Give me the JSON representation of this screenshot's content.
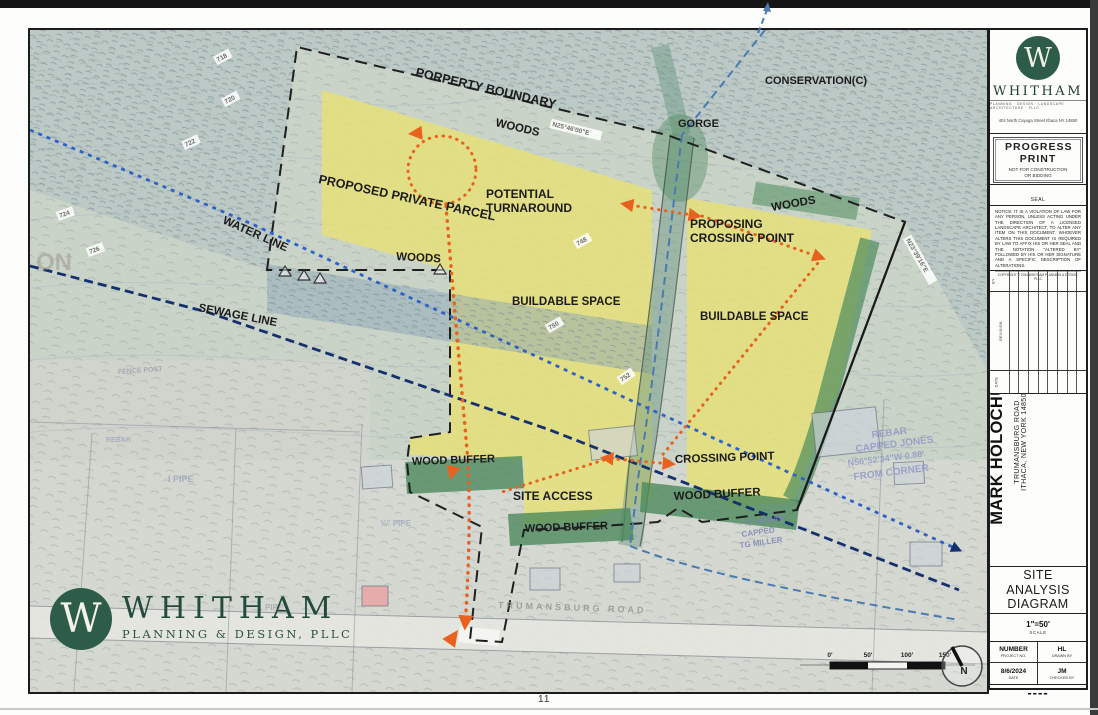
{
  "sheet": {
    "page_number": "11"
  },
  "colors": {
    "brand_green": "#2d5c49",
    "buildable_yellow": "#e7e176",
    "buffer_green": "#4c8a5c",
    "route_orange": "#e8611f",
    "water_blue": "#2e62c8",
    "sewage_navy": "#14306e",
    "stream_blue": "#4a7ab0"
  },
  "footer_logo": {
    "monogram": "W",
    "name": "WHITHAM",
    "tagline": "PLANNING & DESIGN, PLLC"
  },
  "titleblock": {
    "monogram": "W",
    "firm": "WHITHAM",
    "firm_tagline": "PLANNING · DESIGN · LANDSCAPE ARCHITECTURE · PLLC",
    "address": "404 North Cayuga Street Ithaca NY 14850",
    "progress_big": "PROGRESS PRINT",
    "progress_sub": "NOT FOR CONSTRUCTION OR BIDDING",
    "seal_label": "SEAL",
    "notice": "NOTICE: IT IS A VIOLATION OF LAW FOR ANY PERSON, UNLESS ACTING UNDER THE DIRECTION OF A LICENSED LANDSCAPE ARCHITECT, TO ALTER ANY ITEM ON THIS DOCUMENT. WHOEVER ALTERS THIS DOCUMENT IS REQUIRED BY LAW TO AFFIX HIS OR HER SEAL AND THE NOTATION \"ALTERED BY\" FOLLOWED BY HIS OR HER SIGNATURE AND A SPECIFIC DESCRIPTION OF ALTERATIONS.",
    "copyright": "COPYRIGHT © 2024 WHITHAM PLANNING & DESIGN, PLLC",
    "revisions": {
      "by": "BY",
      "revision": "REVISION",
      "date": "DATE",
      "row_count": 9
    },
    "project_line1": "HOLOCHUCK HOUSING",
    "project_line2": "MARK HOLOCHUCK",
    "project_line3": "TRUMANSBURG ROAD",
    "project_line4": "ITHACA, NEW YORK 14850",
    "sheet_title": "SITE ANALYSIS DIAGRAM",
    "scale_value": "1\"=50'",
    "scale_label": "SCALE",
    "project_no_value": "NUMBER",
    "project_no_label": "PROJECT NO.",
    "drawn_value": "HL",
    "drawn_label": "DRAWN BY",
    "date_value": "8/6/2024",
    "date_label": "DATE",
    "checked_value": "JM",
    "checked_label": "CHECKED BY",
    "sheet_no": "----"
  },
  "map": {
    "north_label": "N",
    "scalebar": {
      "labels": [
        "0'",
        "50'",
        "100'",
        "150'"
      ],
      "xs": [
        800,
        838,
        877,
        915
      ],
      "y": 627
    },
    "labels": [
      {
        "t": "PORPERTY BOUNDARY",
        "x": 385,
        "y": 46,
        "r": 13,
        "s": 12.5
      },
      {
        "t": "WOODS",
        "x": 465,
        "y": 96,
        "r": 13,
        "s": 11.5
      },
      {
        "t": "CONSERVATION(C)",
        "x": 735,
        "y": 54,
        "r": 0,
        "s": 11
      },
      {
        "t": "GORGE",
        "x": 648,
        "y": 97,
        "r": 0,
        "s": 11
      },
      {
        "t": "PROPOSED PRIVATE PARCEL",
        "x": 288,
        "y": 153,
        "r": 12,
        "s": 12.5
      },
      {
        "t": "POTENTIAL\nTURNAROUND",
        "x": 456,
        "y": 168,
        "r": 0,
        "s": 12
      },
      {
        "t": "WATER LINE",
        "x": 192,
        "y": 193,
        "r": 24,
        "s": 11.5
      },
      {
        "t": "WOODS",
        "x": 366,
        "y": 230,
        "r": 3,
        "s": 11.5
      },
      {
        "t": "SEWAGE LINE",
        "x": 168,
        "y": 281,
        "r": 11,
        "s": 11.5
      },
      {
        "t": "BUILDABLE SPACE",
        "x": 482,
        "y": 275,
        "r": 0,
        "s": 11.5
      },
      {
        "t": "PROPOSING\nCROSSING POINT",
        "x": 660,
        "y": 198,
        "r": 0,
        "s": 12
      },
      {
        "t": "WOODS",
        "x": 742,
        "y": 181,
        "r": -10,
        "s": 11.5
      },
      {
        "t": "BUILDABLE SPACE",
        "x": 670,
        "y": 290,
        "r": 0,
        "s": 11.5
      },
      {
        "t": "WOOD BUFFER",
        "x": 382,
        "y": 435,
        "r": -2,
        "s": 11
      },
      {
        "t": "SITE ACCESS",
        "x": 483,
        "y": 470,
        "r": 0,
        "s": 12
      },
      {
        "t": "WOOD BUFFER",
        "x": 495,
        "y": 502,
        "r": -2,
        "s": 11
      },
      {
        "t": "CROSSING POINT",
        "x": 645,
        "y": 433,
        "r": -2,
        "s": 11.5
      },
      {
        "t": "WOOD BUFFER",
        "x": 644,
        "y": 470,
        "r": -3,
        "s": 11.5
      }
    ],
    "tags": [
      {
        "t": "718",
        "x": 188,
        "y": 32,
        "r": -28
      },
      {
        "t": "720",
        "x": 196,
        "y": 74,
        "r": -28
      },
      {
        "t": "722",
        "x": 156,
        "y": 117,
        "r": -25
      },
      {
        "t": "724",
        "x": 30,
        "y": 188,
        "r": -20
      },
      {
        "t": "726",
        "x": 60,
        "y": 224,
        "r": -20
      },
      {
        "t": "N25°46'00\"E",
        "x": 522,
        "y": 96,
        "r": 14
      },
      {
        "t": "748",
        "x": 548,
        "y": 216,
        "r": -30
      },
      {
        "t": "750",
        "x": 520,
        "y": 300,
        "r": -30
      },
      {
        "t": "752",
        "x": 592,
        "y": 352,
        "r": -35
      },
      {
        "t": "N23°39'16\"E",
        "x": 876,
        "y": 210,
        "r": 60
      }
    ],
    "ghosts": [
      {
        "t": "ON",
        "x": 6,
        "y": 240,
        "r": 0,
        "s": 24,
        "c": "#9b948a",
        "o": 0.5
      },
      {
        "t": "REBAR",
        "x": 842,
        "y": 408,
        "r": -7,
        "s": 10,
        "c": "#8d96c6",
        "o": 0.8
      },
      {
        "t": "CAPPED JONES",
        "x": 826,
        "y": 422,
        "r": -7,
        "s": 10,
        "c": "#8d96c6",
        "o": 0.8
      },
      {
        "t": "N56°52'34\"W 0.88'",
        "x": 818,
        "y": 436,
        "r": -7,
        "s": 9,
        "c": "#8d96c6",
        "o": 0.8
      },
      {
        "t": "FROM CORNER",
        "x": 824,
        "y": 450,
        "r": -7,
        "s": 10,
        "c": "#8d96c6",
        "o": 0.8
      },
      {
        "t": "¾\" REBAR",
        "x": 714,
        "y": 496,
        "r": -8,
        "s": 8,
        "c": "#7b84b4",
        "o": 0.85
      },
      {
        "t": "CAPPED",
        "x": 712,
        "y": 507,
        "r": -8,
        "s": 8,
        "c": "#7b84b4",
        "o": 0.85
      },
      {
        "t": "TG MILLER",
        "x": 710,
        "y": 518,
        "r": -8,
        "s": 8,
        "c": "#7b84b4",
        "o": 0.85
      },
      {
        "t": "TRUMANSBURG ROAD",
        "x": 468,
        "y": 578,
        "r": 2,
        "s": 9,
        "c": "#8f9a90",
        "o": 0.85,
        "ls": 3
      },
      {
        "t": "I PIPE",
        "x": 138,
        "y": 452,
        "r": 0,
        "s": 9,
        "c": "#98a2bd",
        "o": 0.8
      },
      {
        "t": "¾\" PIPE",
        "x": 350,
        "y": 496,
        "r": 0,
        "s": 8,
        "c": "#98a2bd",
        "o": 0.7
      },
      {
        "t": "FENCE POST",
        "x": 88,
        "y": 344,
        "r": -4,
        "s": 7,
        "c": "#9aa0aa",
        "o": 0.8
      },
      {
        "t": "REBAR",
        "x": 76,
        "y": 412,
        "r": 0,
        "s": 7,
        "c": "#98a2bd",
        "o": 0.7
      },
      {
        "t": "L PIPE",
        "x": 228,
        "y": 580,
        "r": 0,
        "s": 8,
        "c": "#9aa0aa",
        "o": 0.7
      }
    ]
  }
}
